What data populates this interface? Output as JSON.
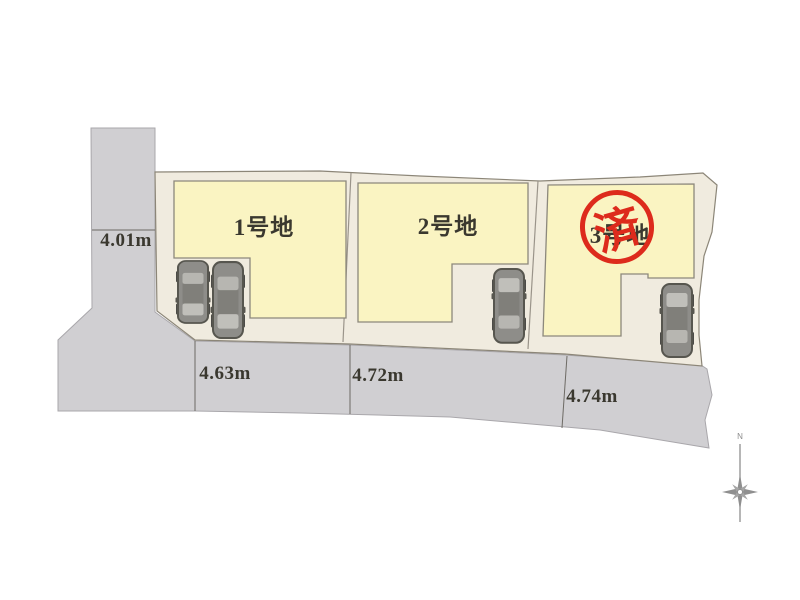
{
  "site_plan": {
    "title_context": "lot-layout-plan",
    "lots": [
      {
        "label": "1号地"
      },
      {
        "label": "2号地"
      },
      {
        "label": "3号地",
        "stamp": "済"
      }
    ],
    "dimensions": {
      "west_road_width": "4.01m",
      "south_frontages": [
        "4.63m",
        "4.72m",
        "4.74m"
      ]
    },
    "compass": {
      "north": "N"
    },
    "icons": {
      "car": "car-top-view-icon",
      "compass": "compass-rose-icon"
    },
    "colors": {
      "road_fill": "#d0cfd2",
      "site_fill": "#f0ebdf",
      "lot_fill": "#faf4c2",
      "stamp_red": "#dd2b1c",
      "outline": "#8c8678"
    }
  }
}
